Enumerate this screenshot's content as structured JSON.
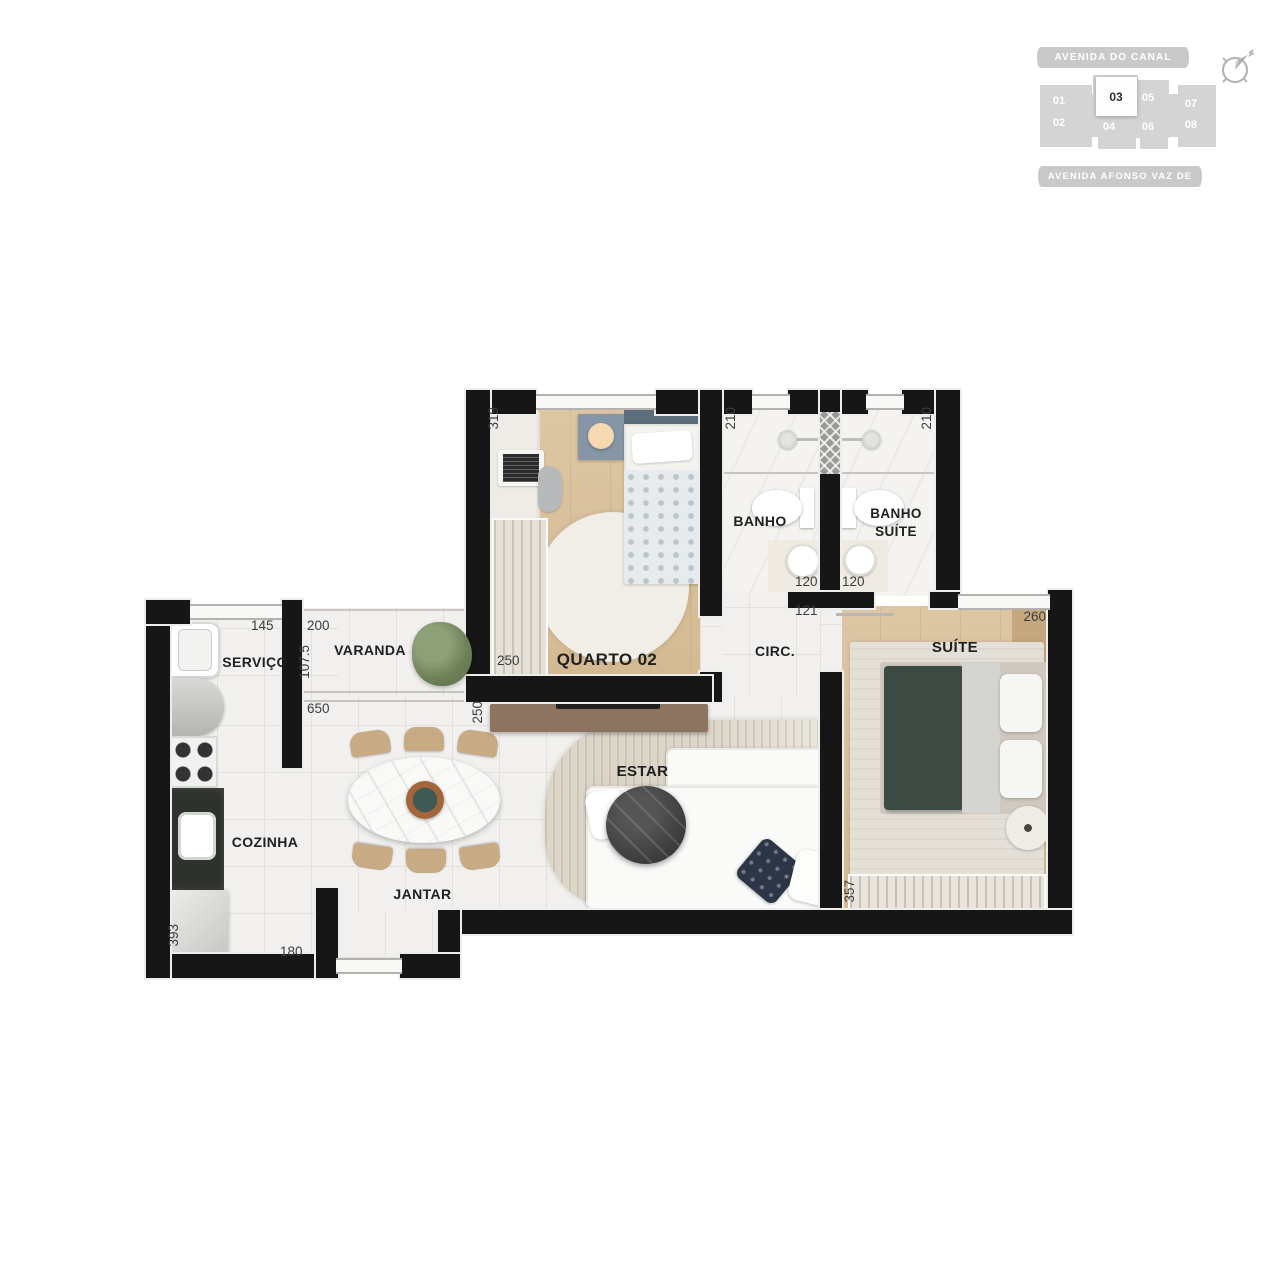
{
  "locator": {
    "street_top": "AVENIDA DO CANAL",
    "street_bottom": "AVENIDA AFONSO VAZ DE MELO",
    "highlighted_unit": "03",
    "units": [
      {
        "label": "01",
        "highlighted": false
      },
      {
        "label": "02",
        "highlighted": false
      },
      {
        "label": "03",
        "highlighted": true
      },
      {
        "label": "04",
        "highlighted": false
      },
      {
        "label": "05",
        "highlighted": false
      },
      {
        "label": "06",
        "highlighted": false
      },
      {
        "label": "07",
        "highlighted": false
      },
      {
        "label": "08",
        "highlighted": false
      }
    ],
    "compass_icon": "compass-northeast-icon"
  },
  "plan": {
    "rooms": {
      "quarto02": "QUARTO 02",
      "banho": "BANHO",
      "banho_suite": "BANHO SUÍTE",
      "circ": "CIRC.",
      "suite": "SUÍTE",
      "varanda": "VARANDA",
      "servico": "SERVIÇO",
      "cozinha": "COZINHA",
      "jantar": "JANTAR",
      "estar": "ESTAR"
    },
    "dims": {
      "quarto02_depth": "319",
      "quarto02_closet": "250",
      "quarto02_width": "250",
      "banho_depth": "210",
      "banho_width": "120",
      "banho_suite_depth": "210",
      "banho_suite_width": "120",
      "circ_width": "121",
      "suite_width": "260",
      "suite_depth": "357",
      "servico_width": "145",
      "varanda_width": "200",
      "varanda_depth": "107.5",
      "living_width": "650",
      "cozinha_depth": "393",
      "entry_width": "180"
    },
    "colors": {
      "wall": "#161616",
      "wood_floor": "#d8c09e",
      "tile_floor": "#f1f0ee",
      "suite_bed_blanket": "#3d4a42",
      "estar_rug": "#dcd6c9",
      "dining_chair": "#c8ab85",
      "tv_console": "#8c7460",
      "locator_gray": "#d4d4d4"
    }
  }
}
